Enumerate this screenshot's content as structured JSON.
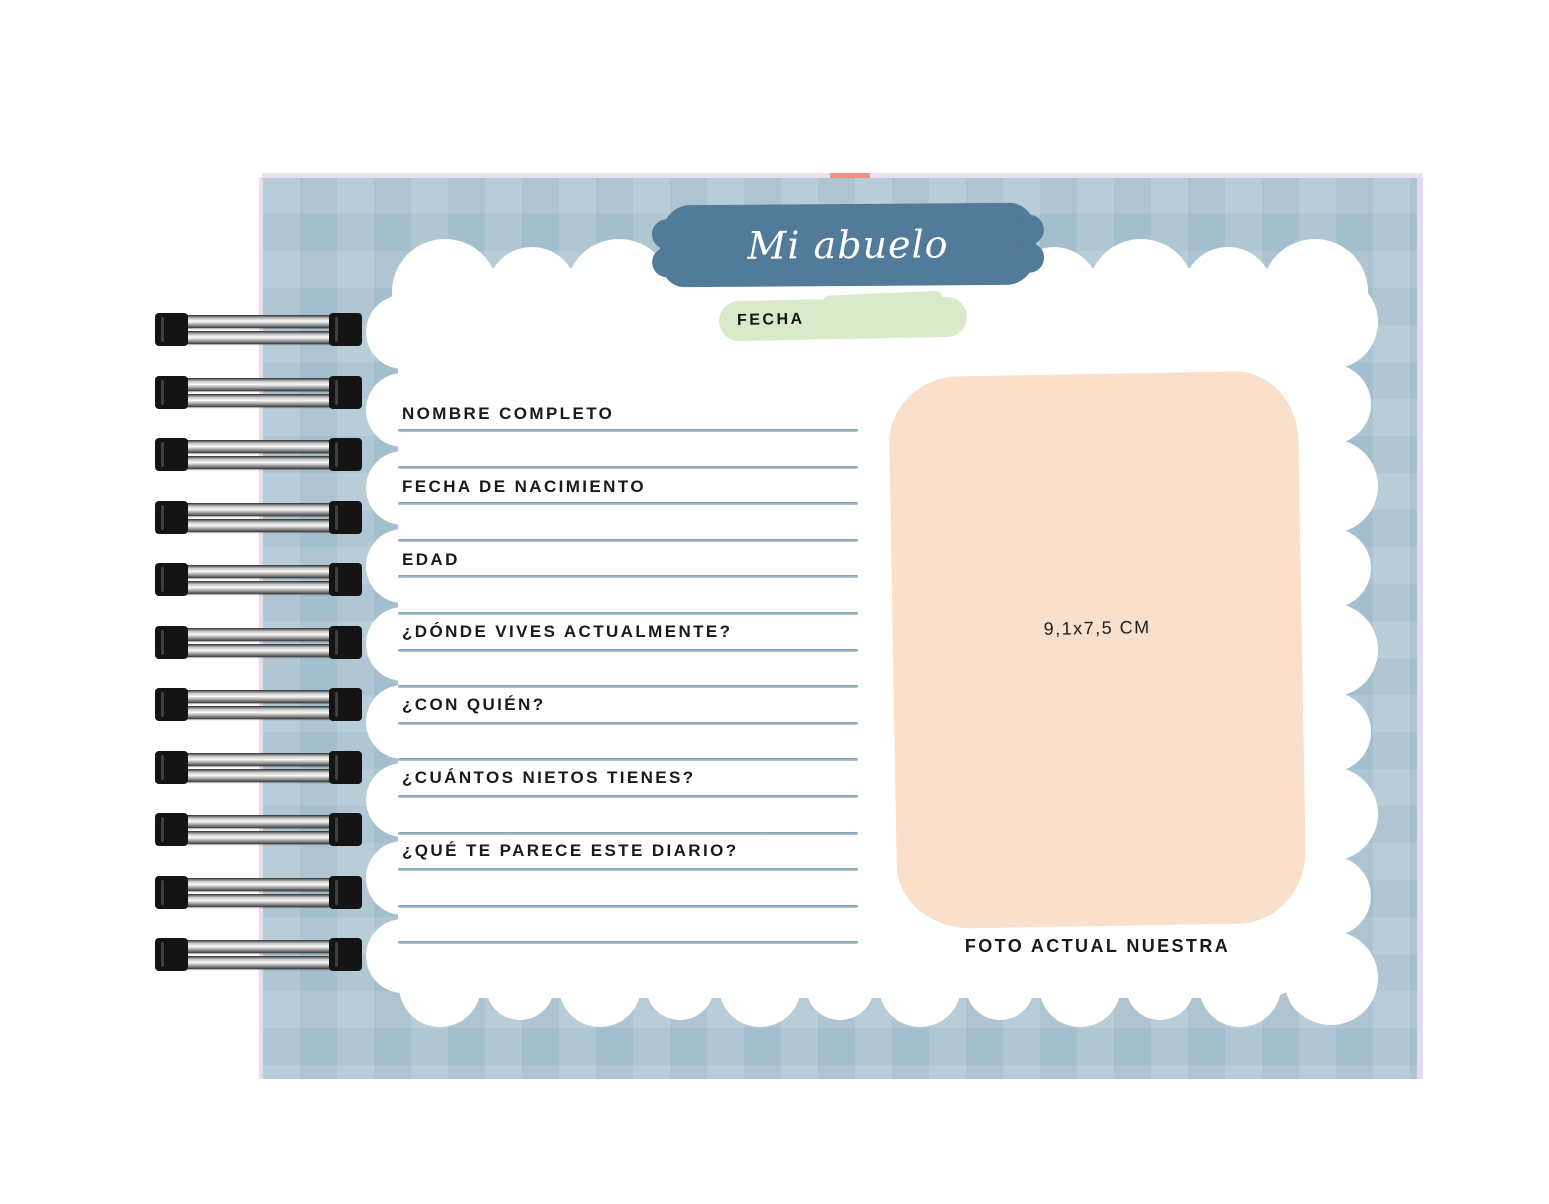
{
  "header": {
    "title": "Mi abuelo",
    "date_label": "FECHA"
  },
  "form": {
    "fields": [
      "NOMBRE COMPLETO",
      "FECHA DE NACIMIENTO",
      "EDAD",
      "¿DÓNDE VIVES ACTUALMENTE?",
      "¿CON QUIÉN?",
      "¿CUÁNTOS NIETOS TIENES?",
      "¿QUÉ TE PARECE ESTE DIARIO?"
    ]
  },
  "photo": {
    "size_hint": "9,1x7,5 CM",
    "caption": "FOTO ACTUAL NUESTRA"
  },
  "colors": {
    "cover_blue": "#9cb9c8",
    "banner_blue": "#527a99",
    "date_green": "#d8eaca",
    "photo_peach": "#fadfcb",
    "ruled_line_blue": "#7d9db0",
    "edge_lavender": "#e9dcec",
    "tab_salmon": "#f28e88",
    "text_black": "#191919"
  }
}
